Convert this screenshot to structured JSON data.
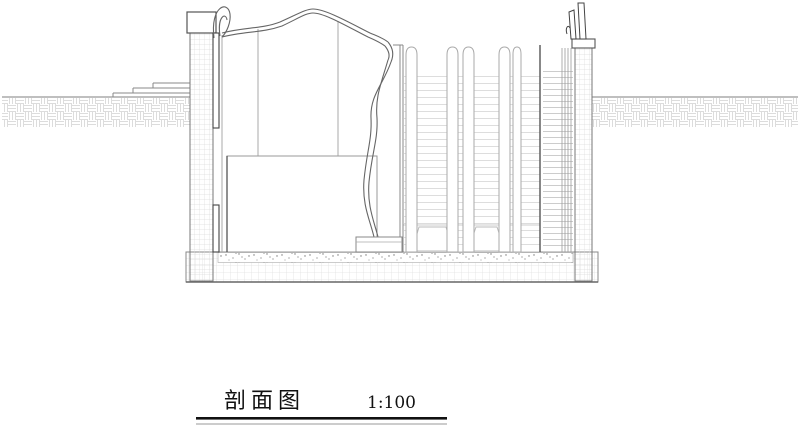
{
  "title_block": {
    "title": "剖面图",
    "scale": "1:100"
  },
  "drawing": {
    "type": "architectural-section",
    "parts": [
      "ground-left",
      "entry-steps",
      "left-wall",
      "canopy-roof",
      "canopy-curl",
      "hanging-curtain",
      "central-hall",
      "escalator-bank",
      "stair-run",
      "right-wall",
      "railing-posts",
      "floor-slab",
      "ground-right"
    ]
  },
  "colors": {
    "background": "#ffffff",
    "outline": "#666666",
    "dark_line": "#333333",
    "hatch_light": "#dcdcdc",
    "title_rule": "#111111"
  }
}
